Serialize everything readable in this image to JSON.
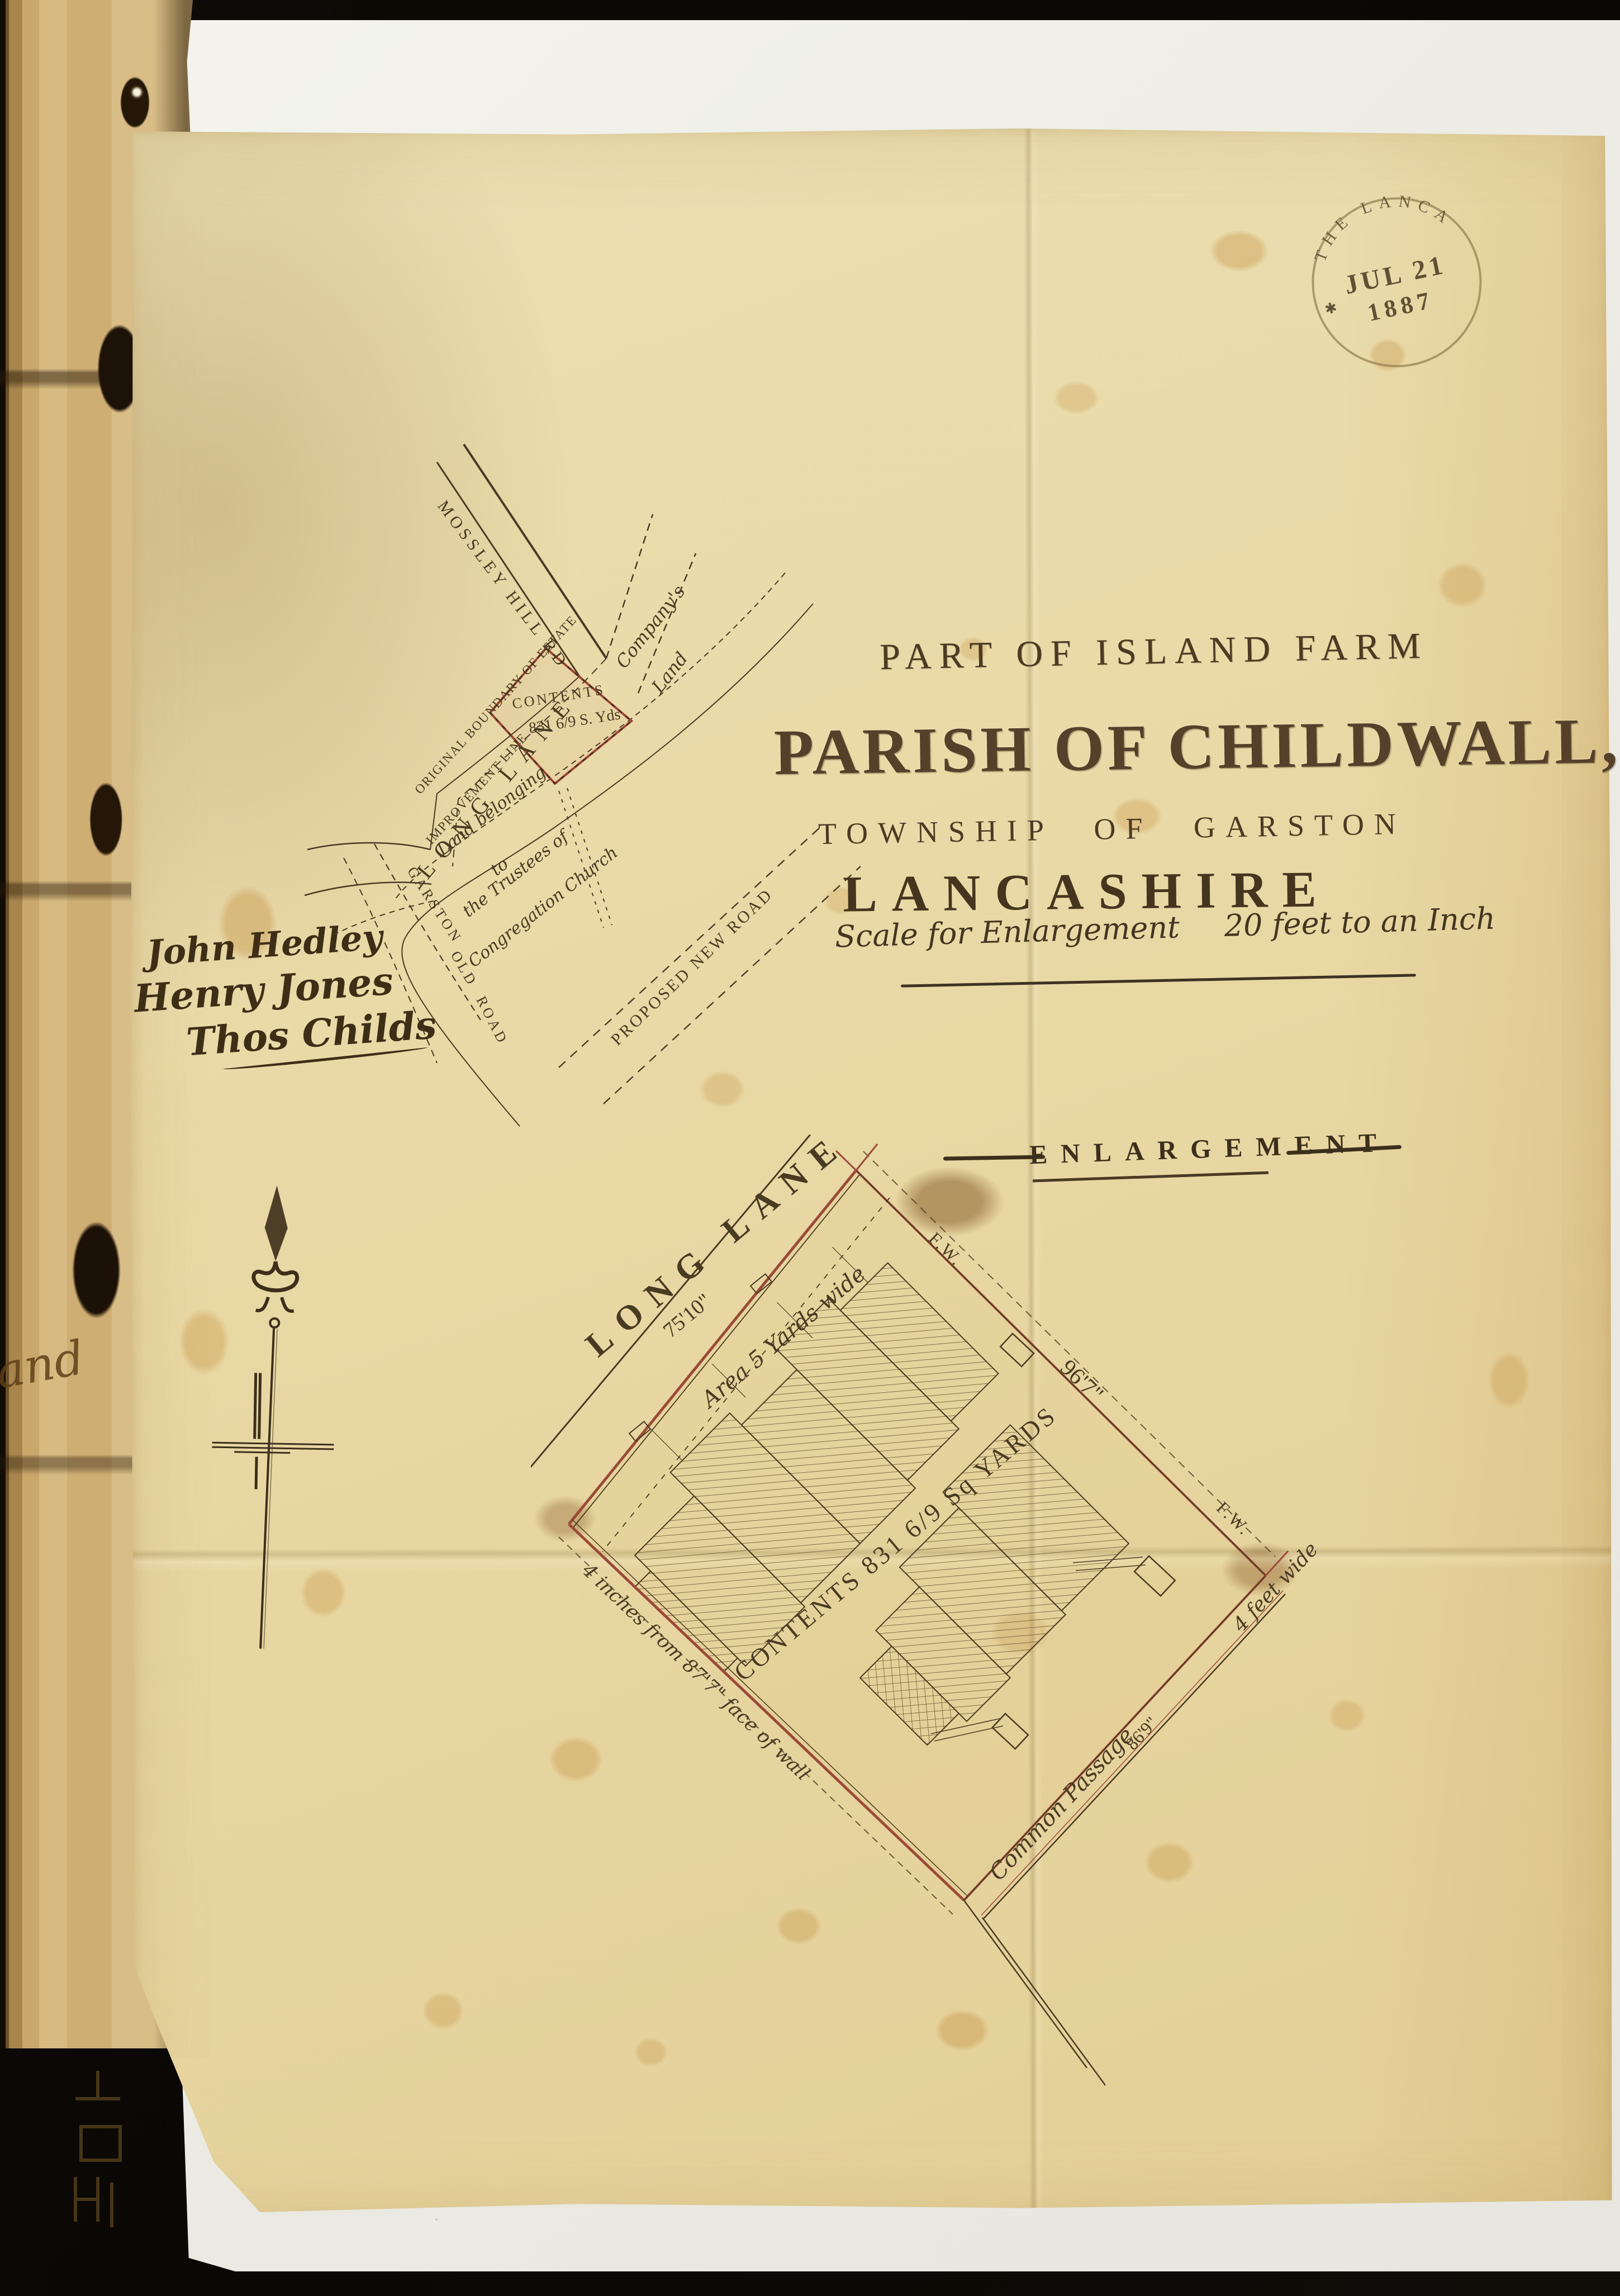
{
  "stamp": {
    "arc_text": "THE LANCA",
    "star": "✱",
    "date_line": "JUL 21",
    "year_line": "1887"
  },
  "title": {
    "line1": "PART OF ISLAND FARM",
    "line2": "PARISH OF CHILDWALL,",
    "line3": "TOWNSHIP OF GARSTON",
    "line4": "LANCASHIRE"
  },
  "scale_note": {
    "label": "Scale for Enlargement",
    "value": "20 feet to an Inch"
  },
  "signatures": {
    "name1": "John Hedley",
    "name2": "Henry Jones",
    "name3": "Thos Childs"
  },
  "location_plan": {
    "mossley_hill_rd": "MOSSLEY HILL RD",
    "long_lane": "LONG LANE",
    "garston_1": "GARSTON",
    "garston_2": "OLD",
    "garston_3": "ROAD",
    "proposed_new_road": "PROPOSED NEW ROAD",
    "original_boundary": "ORIGINAL BOUNDARY OF ESTATE",
    "improvement_line": "IMPROVEMENT LINE",
    "contents_label": "CONTENTS",
    "contents_value": "831 6/9 S. Yds",
    "companys_1": "Company's",
    "companys_2": "Land",
    "trustees_1": "Land belonging",
    "trustees_2": "to",
    "trustees_3": "the Trustees of",
    "trustees_4": "Congregation Church"
  },
  "enlargement": {
    "heading": "ENLARGEMENT",
    "long_lane": "LONG LANE",
    "frontage_dim": "75'10\"",
    "side_dim": "96'7\"",
    "fw_top": "F.W.",
    "fw_bottom": "F.W.",
    "area_note": "Area 5 Yards wide",
    "contents": "CONTENTS 831 6/9 Sq YARDS",
    "wall_note": "4 inches from 87'7\" face of wall",
    "passage_name": "Common Passage",
    "passage_dim": "86'9\"",
    "passage_width": "4 feet wide"
  },
  "margin_fragment": "land"
}
